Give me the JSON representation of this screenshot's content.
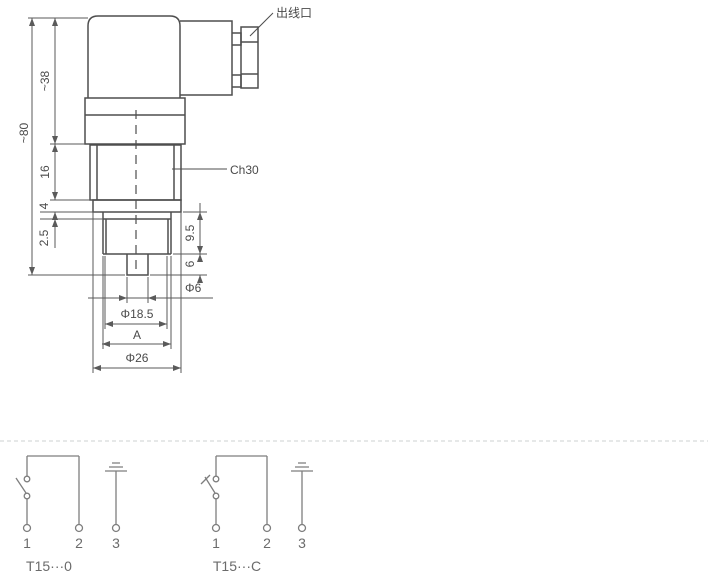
{
  "drawing": {
    "callouts": {
      "cable_outlet": "出线口",
      "hex_flats": "Ch30"
    },
    "dimensions": {
      "overall_height": "~80",
      "head_height": "~38",
      "hex_height": "16",
      "collar_height": "4",
      "step_height": "2.5",
      "thread_length": "9.5",
      "tip_length": "6",
      "tip_diameter": "Φ6",
      "thread_diameter": "Φ18.5",
      "thread_size": "A",
      "body_diameter": "Φ26"
    }
  },
  "circuits": [
    {
      "label": "T15···0",
      "terminals": [
        "1",
        "2",
        "3"
      ]
    },
    {
      "label": "T15···C",
      "terminals": [
        "1",
        "2",
        "3"
      ]
    }
  ],
  "colors": {
    "outline": "#4e4e4e",
    "dimension": "#5a5a5a",
    "circuit": "#7e7e7e",
    "separator": "#ccd0d0",
    "background": "#ffffff"
  }
}
